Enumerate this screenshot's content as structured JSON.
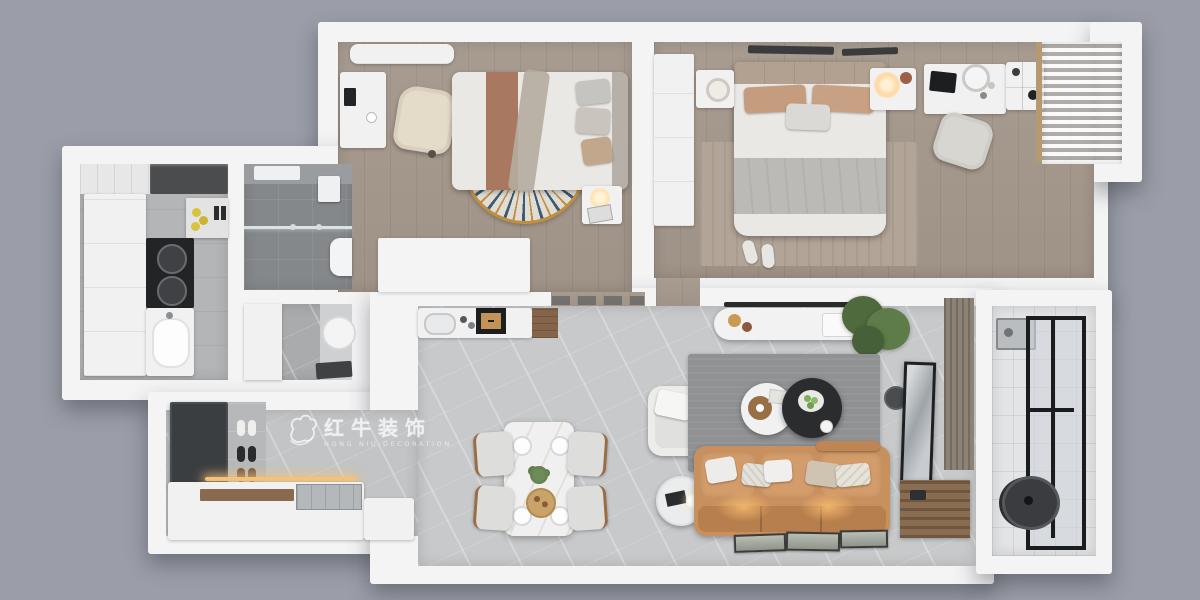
{
  "watermark": {
    "logo_name": "bull-logo",
    "title_cn": "红牛装饰",
    "subtitle_en": "HONG NIU DECORATION"
  },
  "rooms": [
    {
      "id": "bedroom-secondary",
      "position": "top-left",
      "floor": "grey-wood-plank"
    },
    {
      "id": "bedroom-master",
      "position": "top-right",
      "floor": "grey-wood-plank"
    },
    {
      "id": "kitchen",
      "position": "left",
      "floor": "grey-tile"
    },
    {
      "id": "bathroom-shower",
      "position": "left-center",
      "floor": "dark-grey-tile"
    },
    {
      "id": "washbasin-alcove",
      "position": "left-center-lower",
      "floor": "grey-marble"
    },
    {
      "id": "entry-foyer",
      "position": "bottom-left",
      "floor": "grey-marble"
    },
    {
      "id": "living-dining",
      "position": "center-bottom",
      "floor": "light-grey-marble"
    },
    {
      "id": "balcony",
      "position": "right",
      "floor": "white-tile"
    }
  ],
  "colors": {
    "bg": "#9b9ea8",
    "wall": "#f4f4f5",
    "whitef": "#f1f1f2",
    "wood": "#a89c91",
    "wood2": "#9f9286",
    "marble": "#c7c9ca",
    "ktile": "#b3b5b7",
    "bath": "#85888b",
    "balcony": "#e3e4e6",
    "sofa": "#c9905f",
    "sofadark": "#b87f4e",
    "ruglv": "#8f9193",
    "rugms": "#b2a598",
    "rugbd": "#e0ddd7",
    "navy": "#3e5a6e",
    "gold": "#c0903f",
    "duvet": "#eae8e5",
    "blanket": "#bcbab7",
    "pillowtan": "#c59c7d",
    "stripebrown": "#a87860",
    "darkcab": "#3b3e41",
    "black": "#232426",
    "cream": "#e5dbc9",
    "woodbrown": "#8a6a4e",
    "glowwarm": "#f3c27b",
    "plant": "#55713f"
  }
}
